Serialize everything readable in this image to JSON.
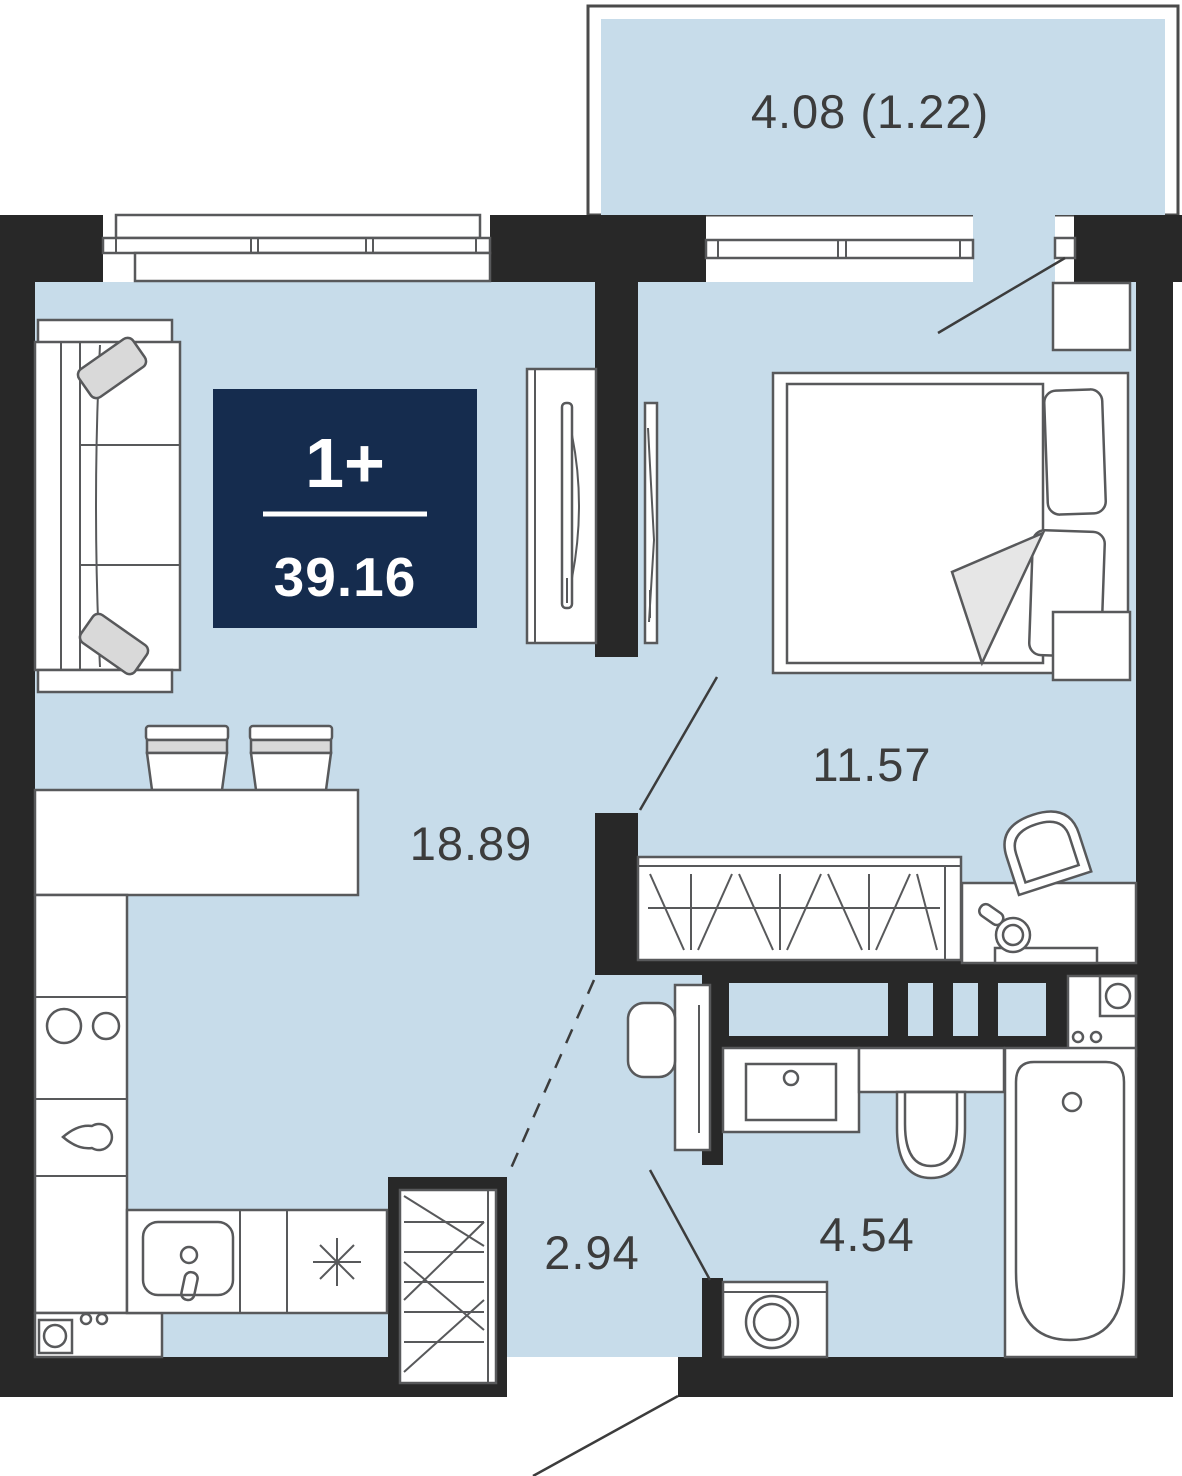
{
  "plan": {
    "type": "apartment-floor-plan",
    "badge": {
      "rooms_label": "1+",
      "total_area": "39.16"
    },
    "rooms": {
      "balcony": {
        "area_label": "4.08 (1.22)"
      },
      "bedroom": {
        "area_label": "11.57"
      },
      "living_kitchen": {
        "area_label": "18.89"
      },
      "hallway": {
        "area_label": "2.94"
      },
      "bathroom": {
        "area_label": "4.54"
      }
    },
    "furniture_symbols": [
      "sofa",
      "wardrobe",
      "mirror-panel",
      "bar-counter",
      "bar-stools",
      "cooktop-burners",
      "kitchen-sink",
      "stove-asterisk",
      "entrance-closet",
      "bed",
      "nightstands",
      "bedroom-wardrobe",
      "dressing-table",
      "chair",
      "bath-vanity",
      "toilet",
      "bathtub",
      "washing-machine"
    ],
    "colors": {
      "floor": "#c7dcea",
      "walls": "#282828",
      "badge_bg": "#152c4e",
      "badge_text": "#ffffff",
      "label_text": "#3c3c3c",
      "furniture_stroke": "#58595b",
      "soft_gray": "#d9d9d9"
    }
  }
}
